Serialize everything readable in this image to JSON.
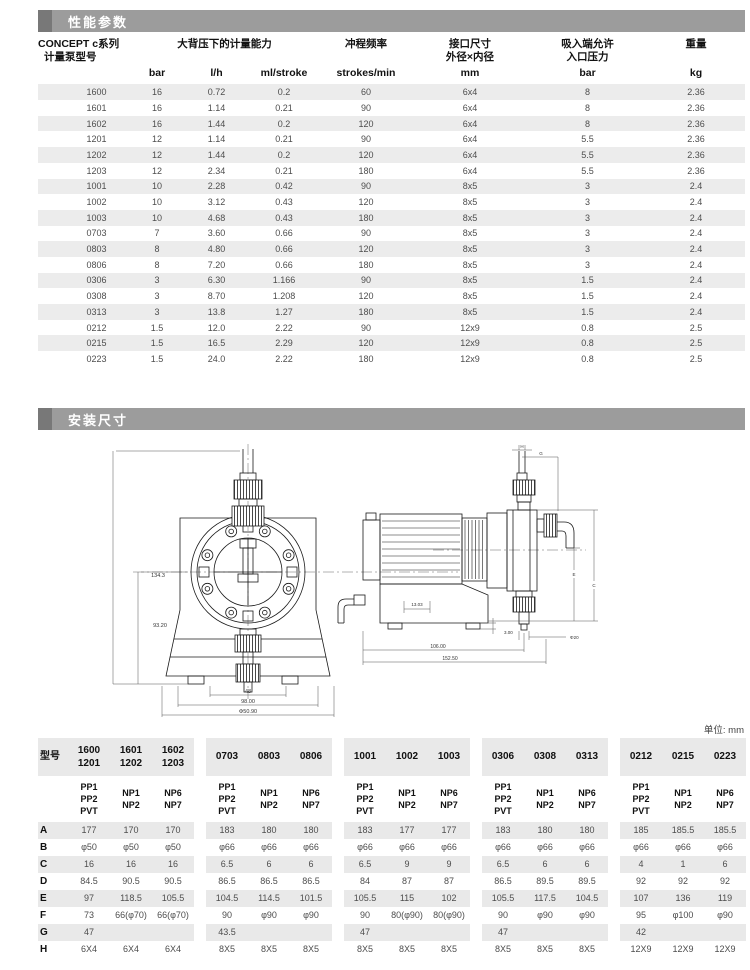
{
  "sections": {
    "performance_title": "性能参数",
    "installation_title": "安装尺寸"
  },
  "unit_note": "单位: mm",
  "performance_table": {
    "model_header_line1": "CONCEPT c系列",
    "model_header_line2": "计量泵型号",
    "capacity_header": "大背压下的计量能力",
    "stroke_header": "冲程频率",
    "port_header": "接口尺寸\n外径×内径",
    "suction_header": "吸入端允许\n入口压力",
    "weight_header": "重量",
    "unit_row": [
      "bar",
      "l/h",
      "ml/stroke",
      "strokes/min",
      "mm",
      "bar",
      "kg"
    ],
    "rows": [
      [
        "1600",
        "16",
        "0.72",
        "0.2",
        "60",
        "6x4",
        "8",
        "2.36"
      ],
      [
        "1601",
        "16",
        "1.14",
        "0.21",
        "90",
        "6x4",
        "8",
        "2.36"
      ],
      [
        "1602",
        "16",
        "1.44",
        "0.2",
        "120",
        "6x4",
        "8",
        "2.36"
      ],
      [
        "1201",
        "12",
        "1.14",
        "0.21",
        "90",
        "6x4",
        "5.5",
        "2.36"
      ],
      [
        "1202",
        "12",
        "1.44",
        "0.2",
        "120",
        "6x4",
        "5.5",
        "2.36"
      ],
      [
        "1203",
        "12",
        "2.34",
        "0.21",
        "180",
        "6x4",
        "5.5",
        "2.36"
      ],
      [
        "1001",
        "10",
        "2.28",
        "0.42",
        "90",
        "8x5",
        "3",
        "2.4"
      ],
      [
        "1002",
        "10",
        "3.12",
        "0.43",
        "120",
        "8x5",
        "3",
        "2.4"
      ],
      [
        "1003",
        "10",
        "4.68",
        "0.43",
        "180",
        "8x5",
        "3",
        "2.4"
      ],
      [
        "0703",
        "7",
        "3.60",
        "0.66",
        "90",
        "8x5",
        "3",
        "2.4"
      ],
      [
        "0803",
        "8",
        "4.80",
        "0.66",
        "120",
        "8x5",
        "3",
        "2.4"
      ],
      [
        "0806",
        "8",
        "7.20",
        "0.66",
        "180",
        "8x5",
        "3",
        "2.4"
      ],
      [
        "0306",
        "3",
        "6.30",
        "1.166",
        "90",
        "8x5",
        "1.5",
        "2.4"
      ],
      [
        "0308",
        "3",
        "8.70",
        "1.208",
        "120",
        "8x5",
        "1.5",
        "2.4"
      ],
      [
        "0313",
        "3",
        "13.8",
        "1.27",
        "180",
        "8x5",
        "1.5",
        "2.4"
      ],
      [
        "0212",
        "1.5",
        "12.0",
        "2.22",
        "90",
        "12x9",
        "0.8",
        "2.5"
      ],
      [
        "0215",
        "1.5",
        "16.5",
        "2.29",
        "120",
        "12x9",
        "0.8",
        "2.5"
      ],
      [
        "0223",
        "1.5",
        "24.0",
        "2.22",
        "180",
        "12x9",
        "0.8",
        "2.5"
      ]
    ]
  },
  "drawings": {
    "front_view": {
      "dims": {
        "total_height": "134.3",
        "center_height": "93.20",
        "inner_width": "48",
        "feet_width": "98.00",
        "base_width": "Φ50.90"
      }
    },
    "side_view": {
      "dims": {
        "h": "H",
        "g": "G",
        "e": "E",
        "c": "C",
        "inner_offset": "13.03",
        "foot_height": "3.00",
        "tube_dia": "Φ20",
        "body_length": "106.00",
        "total_length": "152.50"
      }
    }
  },
  "dimension_table": {
    "row_label_header": "型号",
    "model_row": [
      [
        "1600",
        "1201"
      ],
      [
        "1601",
        "1202"
      ],
      [
        "1602",
        "1203"
      ],
      [
        "0703"
      ],
      [
        "0803"
      ],
      [
        "0806"
      ],
      [
        "1001"
      ],
      [
        "1002"
      ],
      [
        "1003"
      ],
      [
        "0306"
      ],
      [
        "0308"
      ],
      [
        "0313"
      ],
      [
        "0212"
      ],
      [
        "0215"
      ],
      [
        "0223"
      ]
    ],
    "material_row": [
      [
        "PP1",
        "PP2",
        "PVT"
      ],
      [
        "NP1",
        "NP2"
      ],
      [
        "NP6",
        "NP7"
      ]
    ],
    "rows": [
      {
        "label": "A",
        "values": [
          "177",
          "170",
          "170",
          "183",
          "180",
          "180",
          "183",
          "177",
          "177",
          "183",
          "180",
          "180",
          "185",
          "185.5",
          "185.5"
        ]
      },
      {
        "label": "B",
        "values": [
          "φ50",
          "φ50",
          "φ50",
          "φ66",
          "φ66",
          "φ66",
          "φ66",
          "φ66",
          "φ66",
          "φ66",
          "φ66",
          "φ66",
          "φ66",
          "φ66",
          "φ66"
        ]
      },
      {
        "label": "C",
        "values": [
          "16",
          "16",
          "16",
          "6.5",
          "6",
          "6",
          "6.5",
          "9",
          "9",
          "6.5",
          "6",
          "6",
          "4",
          "1",
          "6"
        ]
      },
      {
        "label": "D",
        "values": [
          "84.5",
          "90.5",
          "90.5",
          "86.5",
          "86.5",
          "86.5",
          "84",
          "87",
          "87",
          "86.5",
          "89.5",
          "89.5",
          "92",
          "92",
          "92"
        ]
      },
      {
        "label": "E",
        "values": [
          "97",
          "118.5",
          "105.5",
          "104.5",
          "114.5",
          "101.5",
          "105.5",
          "115",
          "102",
          "105.5",
          "117.5",
          "104.5",
          "107",
          "136",
          "119"
        ]
      },
      {
        "label": "F",
        "values": [
          "73",
          "66(φ70)",
          "66(φ70)",
          "90",
          "φ90",
          "φ90",
          "90",
          "80(φ90)",
          "80(φ90)",
          "90",
          "φ90",
          "φ90",
          "95",
          "φ100",
          "φ90"
        ]
      },
      {
        "label": "G",
        "values": [
          "47",
          "",
          "",
          "43.5",
          "",
          "",
          "47",
          "",
          "",
          "47",
          "",
          "",
          "42",
          "",
          ""
        ]
      },
      {
        "label": "H",
        "values": [
          "6X4",
          "6X4",
          "6X4",
          "8X5",
          "8X5",
          "8X5",
          "8X5",
          "8X5",
          "8X5",
          "8X5",
          "8X5",
          "8X5",
          "12X9",
          "12X9",
          "12X9"
        ]
      }
    ]
  }
}
